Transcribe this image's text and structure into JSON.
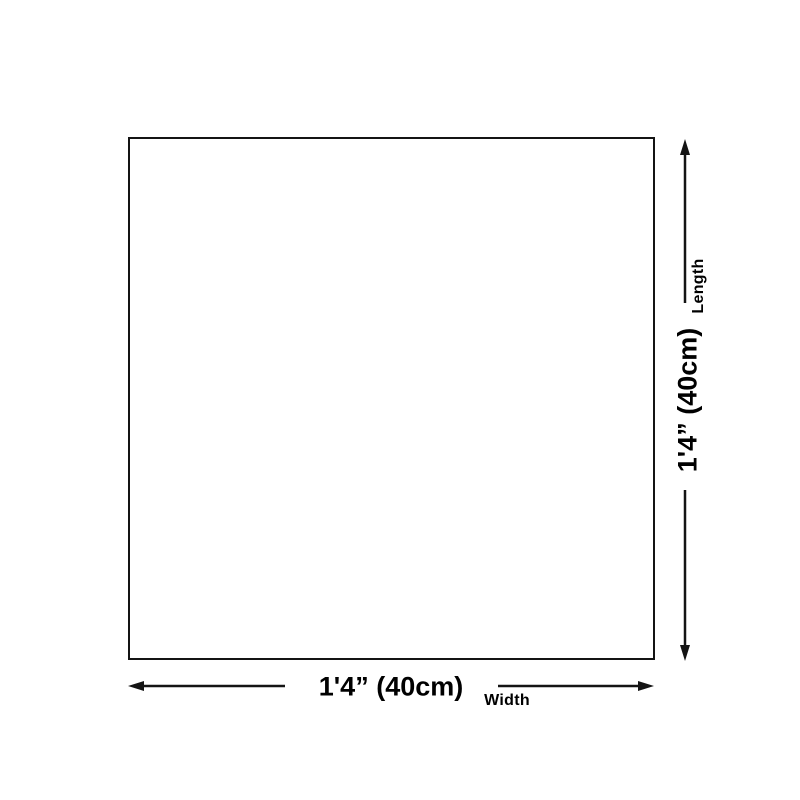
{
  "diagram": {
    "width": {
      "value": "1'4” (40cm)",
      "axis_label": "Width"
    },
    "length": {
      "value": "1'4” (40cm)",
      "axis_label": "Length"
    },
    "colors": {
      "line": "#141414",
      "text": "#000000",
      "background": "#ffffff"
    }
  }
}
